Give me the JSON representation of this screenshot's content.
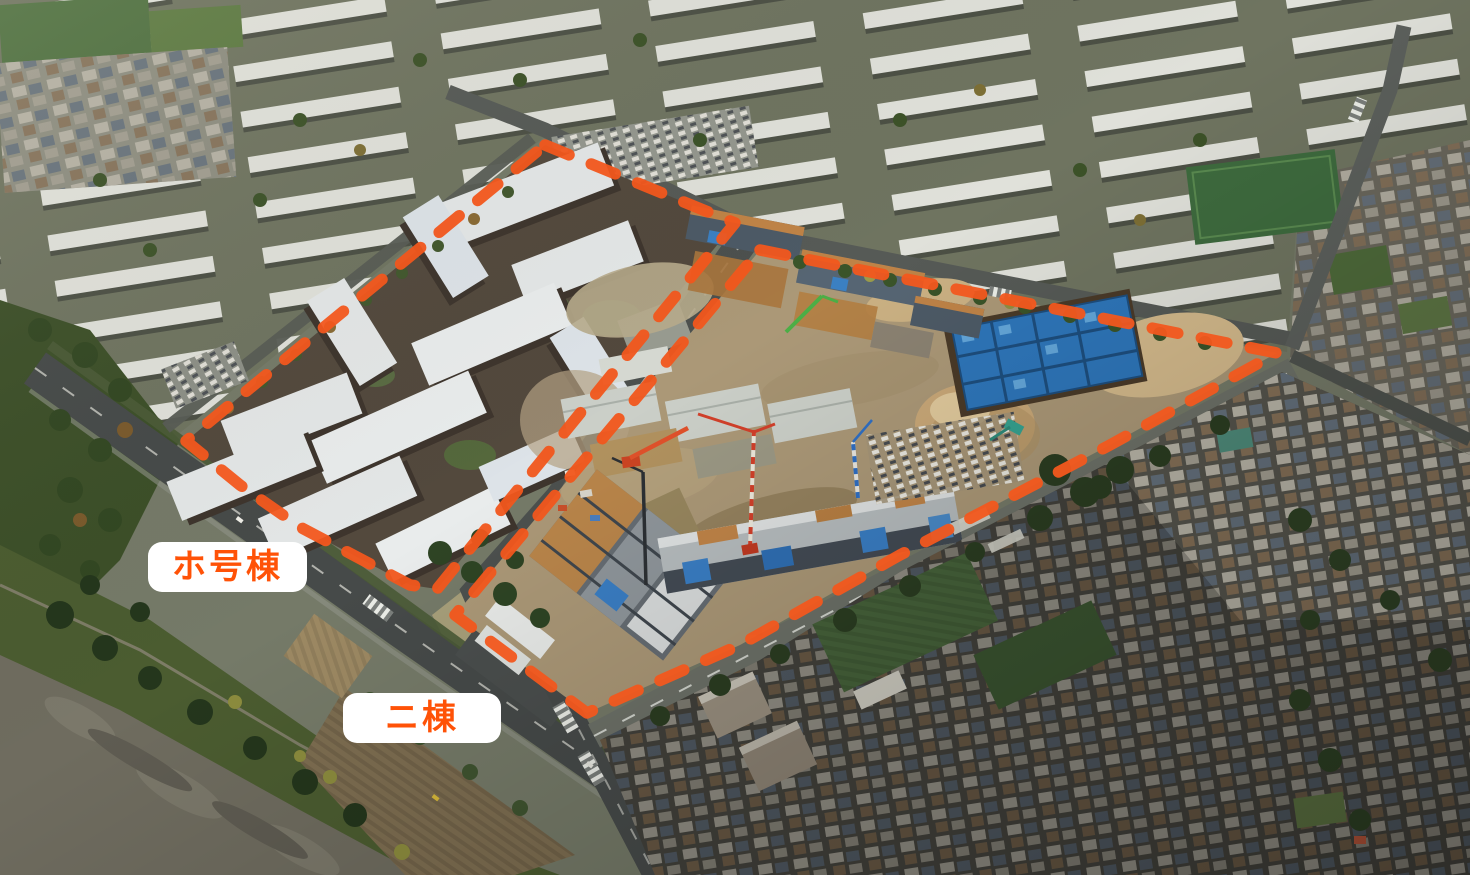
{
  "annotations": {
    "boundary_color": "#F2571D",
    "label_bg_color": "#FFFFFF",
    "label_text_color": "#FF5207",
    "labels": [
      {
        "id": "left-site",
        "text": "ホ号棟"
      },
      {
        "id": "right-site",
        "text": "ニ棟"
      }
    ]
  }
}
